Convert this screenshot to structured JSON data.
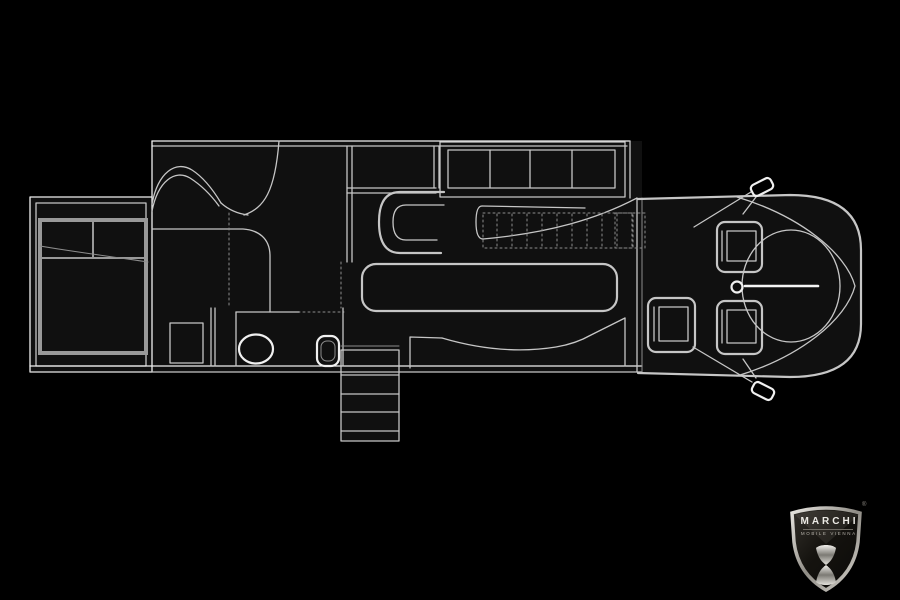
{
  "canvas": {
    "width": 900,
    "height": 600,
    "background": "#000000"
  },
  "palette": {
    "line": "#c6c6c6",
    "line_bright": "#f0f0f0",
    "line_dim": "#8d8d8d",
    "interior": "#101010",
    "bed_frame": "#999999",
    "logo_silver": "#cfcdc9",
    "logo_dark": "#15130f"
  },
  "logo": {
    "brand": "MARCHI",
    "subtitle": "MOBILE VIENNA",
    "registered_mark": "®"
  }
}
